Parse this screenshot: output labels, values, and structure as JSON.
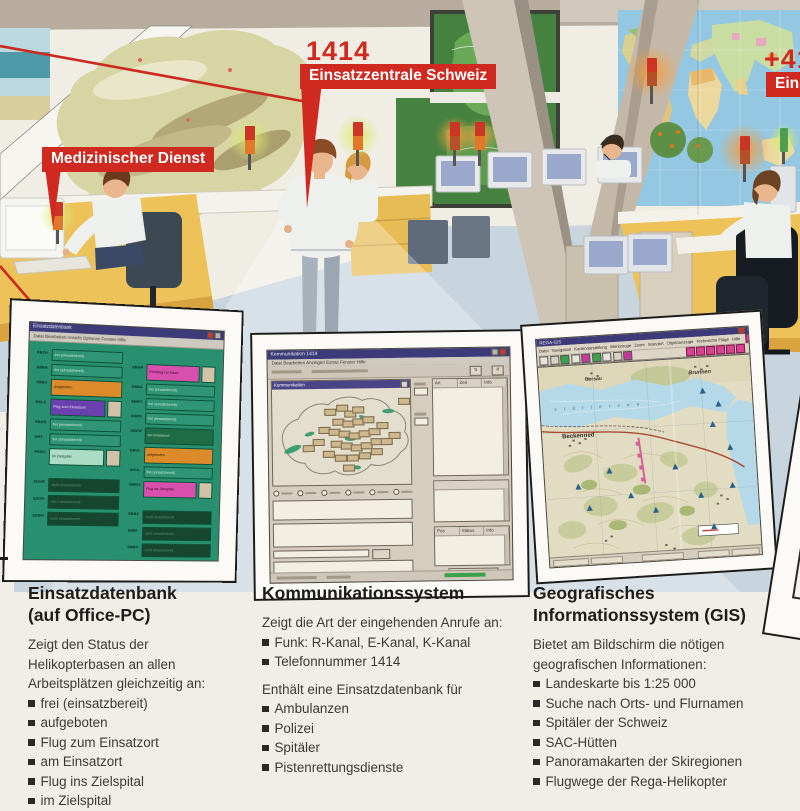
{
  "callouts": {
    "medical_label": "Medizinischer Dienst",
    "phone_number": "1414",
    "center_label": "Einsatzzentrale Schweiz",
    "intl_number": "+41",
    "intl_label": "Eins"
  },
  "panels": {
    "db": {
      "window_title": "Einsatzdatenbank",
      "menu": "Datei  Bearbeiten  Ansicht  Optionen  Fenster  Hilfe",
      "left_rows": [
        {
          "c": "EBZH",
          "s": "frei (einsatzbereit)",
          "t": "free"
        },
        {
          "c": "EBBA",
          "s": "frei (einsatzbereit)",
          "t": "free"
        },
        {
          "c": "EBBX",
          "s": "aufgeboten",
          "t": "orange"
        },
        {
          "c": "EBLS",
          "s": "Flug zum Einsatzort",
          "t": "purple",
          "side": true
        },
        {
          "c": "EBGR",
          "s": "frei (einsatzbereit)",
          "t": "free"
        },
        {
          "c": "EBT",
          "s": "frei (einsatzbereit)",
          "t": "free"
        },
        {
          "c": "FRAG",
          "s": "im Zielspital",
          "t": "teal",
          "side": true
        },
        {
          "c": "EDGR",
          "s": "nicht einsatzbereit",
          "t": "dark",
          "gap": true
        },
        {
          "c": "EDUN",
          "s": "nicht einsatzbereit",
          "t": "dark"
        },
        {
          "c": "EDBO",
          "s": "nicht einsatzbereit",
          "t": "dark"
        }
      ],
      "right_rows": [
        {
          "c": "EBGR",
          "s": "Rückflug zur Basis",
          "t": "pink",
          "side": true
        },
        {
          "c": "EBBA",
          "s": "frei (einsatzbereit)",
          "t": "free"
        },
        {
          "c": "EBBO",
          "s": "frei (einsatzbereit)",
          "t": "free"
        },
        {
          "c": "EBBG",
          "s": "frei (einsatzbereit)",
          "t": "free"
        },
        {
          "c": "EBZW",
          "s": "am Einsatzort",
          "t": "darkgreen"
        },
        {
          "c": "EBGL",
          "s": "aufgeboten",
          "t": "orange"
        },
        {
          "c": "AGUL",
          "s": "frei (einsatzbereit)",
          "t": "free"
        },
        {
          "c": "EBRH",
          "s": "Flug ins Zielspital",
          "t": "pink",
          "side": true
        },
        {
          "c": "EBBZ",
          "s": "nicht einsatzbereit",
          "t": "dark",
          "gap": true
        },
        {
          "c": "EBBI",
          "s": "nicht einsatzbereit",
          "t": "dark"
        },
        {
          "c": "EBBH",
          "s": "nicht einsatzbereit",
          "t": "dark"
        },
        {
          "c": "EBBS",
          "s": "nicht einsatzbereit",
          "t": "dark"
        }
      ]
    },
    "comm": {
      "window_title": "Kommunikation 1414",
      "menu": "Datei  Bearbeiten  Anzeigen  Extras  Fenster  Hilfe",
      "map_title": "Kommunikation",
      "list1_headers": [
        "Art",
        "Zeit",
        "Info"
      ],
      "list2_headers": [
        "Pos",
        "Status",
        "Info"
      ],
      "footer_button": "Akt. Platz"
    },
    "gis": {
      "window_title": "REGA-GIS",
      "menu_items": [
        "Datei",
        "Navigation",
        "Kartendarstellung",
        "Werkzeuge",
        "Zoom",
        "Standort",
        "Objektanzeige",
        "Technische Flüge",
        "Hilfe"
      ],
      "button_numbers": [
        "1",
        "2",
        "3",
        "4",
        "5",
        "6",
        "7",
        "8",
        "9",
        "10",
        "11",
        "12"
      ],
      "towns": {
        "gersau": "Gersau",
        "brunnen": "Brunnen",
        "beckenried": "Beckenried",
        "lake": "s t ä t t e r s e e"
      }
    }
  },
  "sections": [
    {
      "title_lines": [
        "Einsatzdatenbank",
        "(auf Office-PC)"
      ],
      "intro_lines": [
        "Zeigt den Status der",
        "Helikopterbasen an allen",
        "Arbeitsplätzen gleichzeitig an:"
      ],
      "bullets": [
        "frei (einsatzbereit)",
        "aufgeboten",
        "Flug zum Einsatzort",
        "am Einsatzort",
        "Flug ins Zielspital",
        "im Zielspital",
        "Rückflug zur Basis"
      ]
    },
    {
      "title_lines": [
        "Kommunikationssystem"
      ],
      "intro_lines": [
        "Zeigt die Art der eingehenden Anrufe an:"
      ],
      "bullets": [
        "Funk: R-Kanal, E-Kanal, K-Kanal",
        "Telefonnummer 1414"
      ],
      "intro2_lines": [
        "Enthält eine Einsatzdatenbank für"
      ],
      "bullets2": [
        "Ambulanzen",
        "Polizei",
        "Spitäler",
        "Pistenrettungsdienste"
      ]
    },
    {
      "title_lines": [
        "Geografisches",
        "Informationssystem (GIS)"
      ],
      "intro_lines": [
        "Bietet am Bildschirm die nötigen",
        "geografischen Informationen:"
      ],
      "bullets": [
        "Landeskarte bis 1:25 000",
        "Suche nach Orts- und Flurnamen",
        "Spitäler der Schweiz",
        "SAC-Hütten",
        "Panoramakarten der Skiregionen",
        "Flugwege der Rega-Helikopter"
      ]
    }
  ]
}
